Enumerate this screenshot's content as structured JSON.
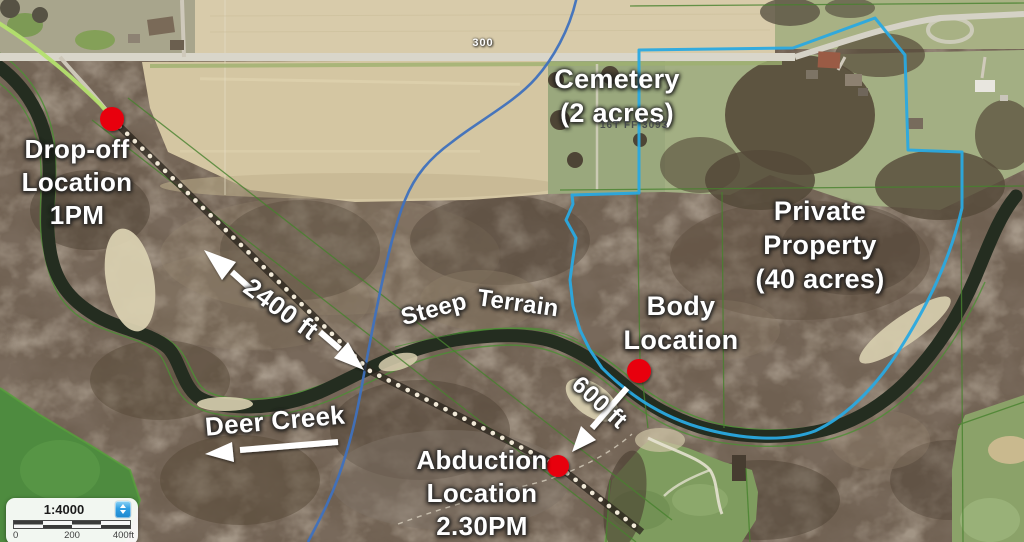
{
  "annotations": {
    "drop_off": "Drop-off\nLocation\n1PM",
    "cemetery": "Cemetery\n(2 acres)",
    "grid_reference": "16T FF 3093",
    "private_property": "Private\nProperty\n(40 acres)",
    "body_location": "Body\nLocation",
    "abduction": "Abduction\nLocation\n2.30PM",
    "steep_terrain_1": "Steep",
    "steep_terrain_2": "Terrain",
    "deer_creek": "Deer Creek",
    "trail_distance": "2400 ft",
    "body_distance": "600 ft",
    "road_number": "300"
  },
  "scale_widget": {
    "ratio": "1:4000",
    "bar_labels": [
      "0",
      "200",
      "400ft"
    ]
  },
  "colors": {
    "boundary_line": "#2aa9e0",
    "stream_line": "#3f71bd",
    "marker_red": "#e8000f",
    "annotation_text": "#ffffff"
  }
}
